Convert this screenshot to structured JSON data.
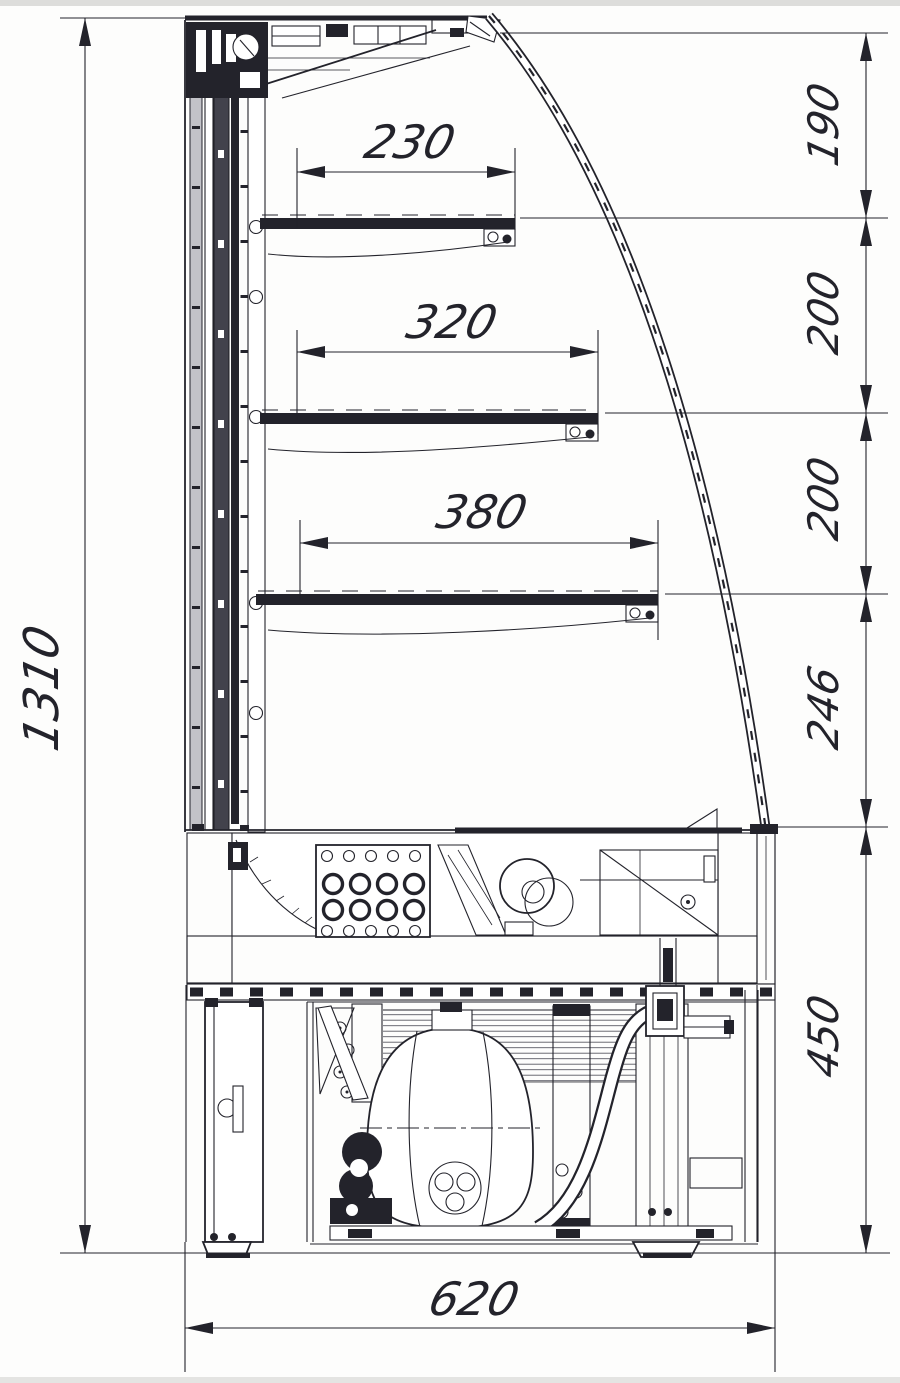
{
  "colors": {
    "line": "#23232b",
    "bg": "#fafaf8",
    "panel": "#c2c2c8",
    "dark_panel": "#42424c",
    "fins": "#5a5a63"
  },
  "dimensions": {
    "overall_height": {
      "value": "1310"
    },
    "base_depth": {
      "value": "620"
    },
    "shelf_widths": [
      {
        "value": "230"
      },
      {
        "value": "320"
      },
      {
        "value": "380"
      }
    ],
    "right_height_segments": [
      {
        "value": "190"
      },
      {
        "value": "200"
      },
      {
        "value": "200"
      },
      {
        "value": "246"
      },
      {
        "value": "450"
      }
    ]
  }
}
